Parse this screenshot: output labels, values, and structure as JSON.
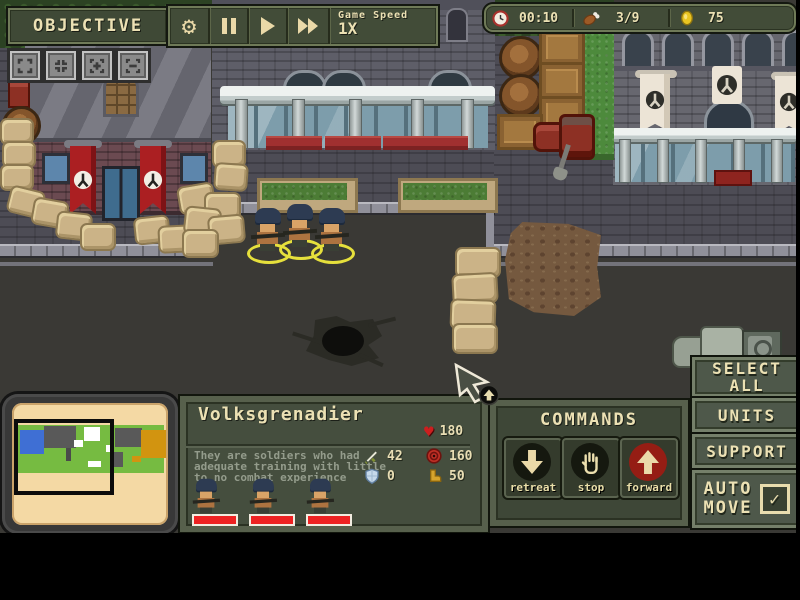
{
  "hud": {
    "objective": "OBJECTIVE",
    "game_speed_label": "Game Speed",
    "game_speed_value": "1X",
    "timer": "00:10",
    "rations": "3/9",
    "gold": "75"
  },
  "glyphs": {
    "gear": "⚙",
    "heart": "♥",
    "check": "✓"
  },
  "unit_panel": {
    "title": "Volksgrenadier",
    "hp": "180",
    "description_lines": [
      "They are soldiers who had",
      "adequate training with little",
      "to no combat experience"
    ],
    "stats": {
      "sword": "42",
      "target": "160",
      "shield": "0",
      "boot": "50"
    }
  },
  "commands": {
    "title": "COMMANDS",
    "retreat": "retreat",
    "stop": "stop",
    "forward": "forward"
  },
  "side_panel": {
    "select_all": [
      "SELECT",
      "ALL"
    ],
    "units": "UNITS",
    "support": "SUPPORT",
    "auto_move": [
      "AUTO",
      "MOVE"
    ]
  },
  "colors": {
    "accent_cream": "#ece1b4",
    "selection_yellow": "#e6e03c",
    "hp_bar_red": "#ee2222",
    "banner_red": "#ab1f22",
    "hud_olive": "#424c38"
  }
}
